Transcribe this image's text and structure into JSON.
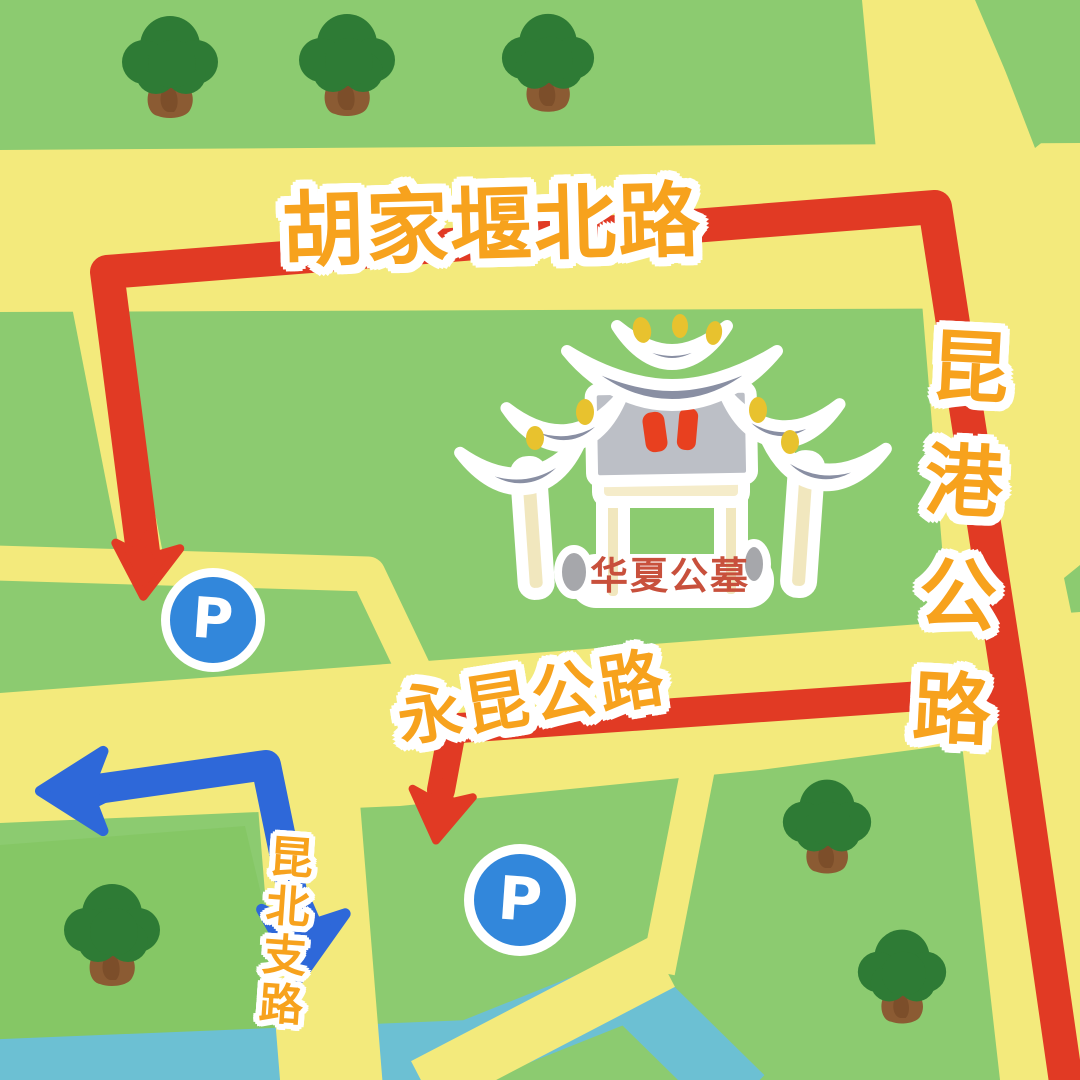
{
  "map": {
    "labels": {
      "top_road": "胡家堰北路",
      "right_road": "昆港公路",
      "middle_road": "永昆公路",
      "branch_road": "昆北支路",
      "cemetery": "华夏公墓",
      "parking_letter": "P"
    },
    "colors": {
      "background_green": "#8ccb70",
      "field_green_dark": "#85c765",
      "road_yellow": "#f3ea7c",
      "route_red": "#e13a24",
      "route_blue": "#2e68d9",
      "parking_blue": "#3287db",
      "river_teal": "#6cc0d3",
      "label_orange": "#f7a21d",
      "cemetery_label_red": "#c8503c",
      "tree_green": "#2e7b35",
      "trunk_brown": "#8b5b33",
      "gate_roof_gray": "#898fa3",
      "gate_plaque_gray": "#bcbfc6",
      "gate_pillar_cream": "#f1e7be",
      "gate_stone_gray": "#a6a7ab",
      "gate_ornament_yellow": "#e8c22e",
      "gate_mark_red": "#e8401f"
    }
  }
}
